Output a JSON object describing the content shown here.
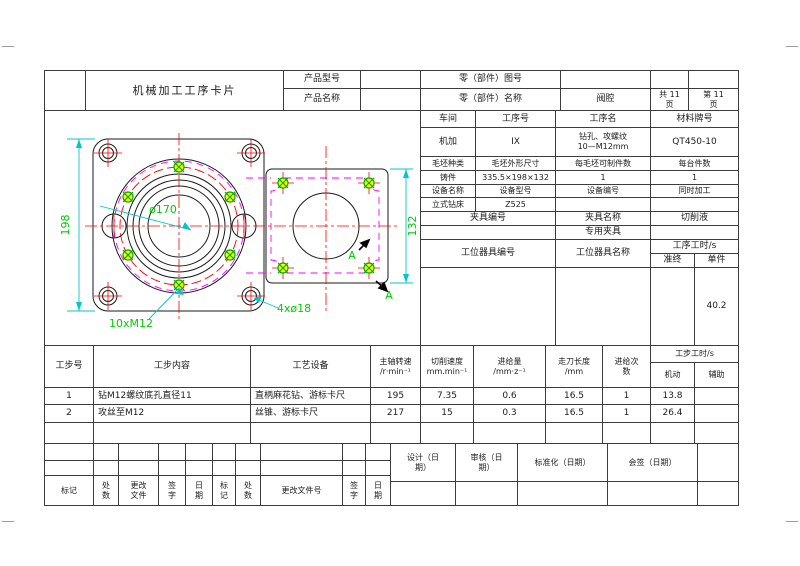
{
  "card": {
    "title": "机械加工工序卡片"
  },
  "header": {
    "product_model_label": "产品型号",
    "product_model_value": "",
    "part_no_label": "零（部件）图号",
    "part_no_value": "",
    "product_name_label": "产品名称",
    "product_name_value": "",
    "part_name_label": "零（部件）名称",
    "part_name_value": "阀腔",
    "pages_total": "共 11\n页",
    "page_no": "第 11\n页"
  },
  "info": {
    "workshop_label": "车间",
    "workshop_value": "机加",
    "process_no_label": "工序号",
    "process_no_value": "IX",
    "process_name_label": "工序名",
    "process_name_value": "钻孔、攻螺纹\n10—M12mm",
    "material_label": "材料牌号",
    "material_value": "QT450-10",
    "blank_type_label": "毛坯种类",
    "blank_type_value": "铸件",
    "blank_size_label": "毛坯外形尺寸",
    "blank_size_value": "335.5×198×132",
    "parts_per_blank_label": "每毛坯可制件数",
    "parts_per_blank_value": "1",
    "parts_per_machine_label": "每台件数",
    "parts_per_machine_value": "1",
    "equipment_name_label": "设备名称",
    "equipment_name_value": "立式钻床",
    "equipment_model_label": "设备型号",
    "equipment_model_value": "Z525",
    "equipment_no_label": "设备编号",
    "equipment_no_value": "",
    "simultaneous_label": "同时加工",
    "simultaneous_value": "",
    "fixture_no_label": "夹具编号",
    "fixture_name_label": "夹具名称",
    "fixture_name_value": "专用夹具",
    "coolant_label": "切削液",
    "coolant_value": "",
    "station_tool_no_label": "工位器具编号",
    "station_tool_name_label": "工位器具名称",
    "process_time_label": "工序工时/s",
    "setup_time_label": "准终",
    "setup_time_value": "",
    "unit_time_label": "单件",
    "unit_time_value": "40.2"
  },
  "steps": {
    "headers": {
      "no": "工步号",
      "content": "工步内容",
      "equipment": "工艺设备",
      "spindle": "主轴转速\n/r·min⁻¹",
      "cut_speed": "切削速度\nmm.min⁻¹",
      "feed": "进给量\n/mm·z⁻¹",
      "length": "走刀长度\n/mm",
      "passes": "进给次\n数",
      "step_time": "工步工时/s",
      "machine": "机动",
      "aux": "辅助"
    },
    "rows": [
      {
        "no": "1",
        "content": "钻M12螺纹底孔直径11",
        "equipment": "直柄麻花钻、游标卡尺",
        "spindle": "195",
        "cut_speed": "7.35",
        "feed": "0.6",
        "length": "16.5",
        "passes": "1",
        "machine": "13.8",
        "aux": ""
      },
      {
        "no": "2",
        "content": "攻丝至M12",
        "equipment": "丝锥、游标卡尺",
        "spindle": "217",
        "cut_speed": "15",
        "feed": "0.3",
        "length": "16.5",
        "passes": "1",
        "machine": "26.4",
        "aux": ""
      }
    ]
  },
  "approval": {
    "design": "设计（日\n期）",
    "audit": "审核（日\n期）",
    "standardization": "标准化（日期）",
    "countersign": "会签（日期）"
  },
  "revision": {
    "mark": "标记",
    "count": "处\n数",
    "change_file": "更改\n文件",
    "sign": "签\n字",
    "date": "日\n期",
    "mark2": "标\n记",
    "count2": "处\n数",
    "change_file_no": "更改文件号",
    "sign2": "签\n字",
    "date2": "日\n期"
  },
  "drawing": {
    "dim_height": "198",
    "dim_width": "132",
    "dim_bolt_circle": "ø170",
    "tapped_holes_label": "10xM12",
    "through_holes_label": "4xø18",
    "section_label_1": "A",
    "section_label_2": "A",
    "colors": {
      "outline": "#1a1a1a",
      "centerline": "#ff0000",
      "hidden_line": "#ff00ff",
      "dimension_line": "#00c8c8",
      "dimension_text": "#00cc00",
      "hole_fill": "#ffff00"
    }
  }
}
